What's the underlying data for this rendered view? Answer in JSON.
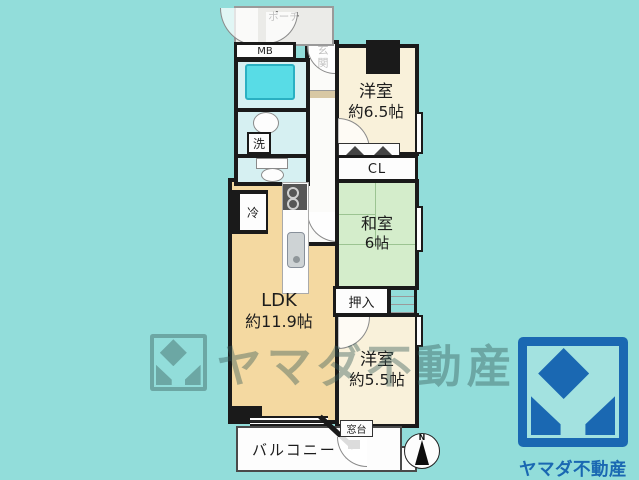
{
  "colors": {
    "background": "#92ddda",
    "wall": "#1a1a1a",
    "ldk_fill": "#f4d9a1",
    "western_room_fill": "#f9f1da",
    "japanese_room_fill": "#d4edcb",
    "wet_area_fill": "#d6f0f2",
    "bathtub_fill": "#58dce6",
    "porch_fill": "#ebebe8",
    "watermark": "rgba(58,92,90,0.42)",
    "logo_blue": "#1a68b2"
  },
  "floor_plan": {
    "porch_label": "ポーチ",
    "meter_box_label": "MB",
    "entrance_label": "玄関",
    "washroom_label": "洗",
    "western_room_1": {
      "name": "洋室",
      "size": "約6.5帖"
    },
    "closet_label": "CL",
    "japanese_room": {
      "name": "和室",
      "size": "6帖"
    },
    "oshiire_label": "押入",
    "ldk": {
      "name": "LDK",
      "size": "約11.9帖"
    },
    "fridge_label": "冷",
    "western_room_2": {
      "name": "洋室",
      "size": "約5.5帖"
    },
    "window_sill_label": "窓台",
    "balcony_label": "バルコニー",
    "compass_north_label": "N"
  },
  "watermark": {
    "text": "ヤマダ不動産"
  },
  "logo": {
    "company_name": "ヤマダ不動産"
  }
}
